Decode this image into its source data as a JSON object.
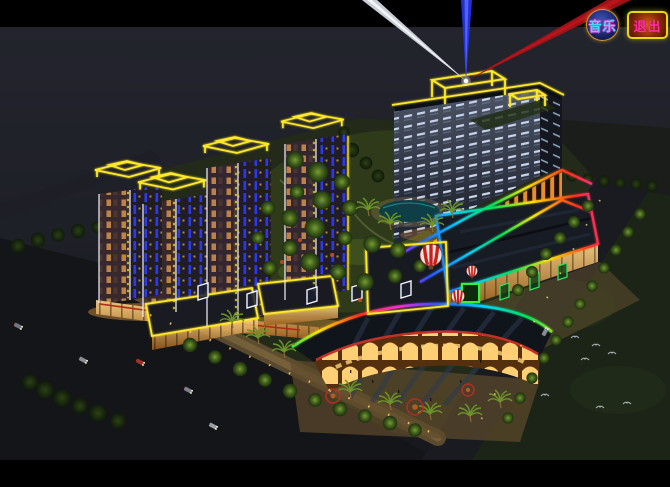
{
  "window": {
    "width": 670,
    "height": 487,
    "letterbox_color": "#000000"
  },
  "toolbar": {
    "music_button": {
      "label": "音乐",
      "text_color": "#4fd8f0",
      "border_color": "#d49a28",
      "bg_color": "#16215e"
    },
    "exit_button": {
      "label": "退出",
      "text_color": "#ff2f9e",
      "border_color": "#ecd616",
      "bg_color": "#8a2a06"
    }
  },
  "scene": {
    "subject": "aerial night lighting rendering of a mixed-use complex",
    "searchlights": [
      {
        "name": "white-beam",
        "color": "#dfe3ec"
      },
      {
        "name": "blue-beam",
        "color": "#2233dd"
      },
      {
        "name": "red-beam",
        "color": "#a91218"
      }
    ],
    "neon": {
      "yellow": "#ffe92a",
      "white": "#f2f4ff",
      "green": "#35f03c",
      "blue": "#2b3cf0",
      "rainbow": [
        "#ff2bd6",
        "#2b50ff",
        "#00d0ff",
        "#00e05a",
        "#ffe400",
        "#ff3020"
      ]
    },
    "elements": [
      "hotel-tower",
      "rooftop-neon-frames",
      "residential-towers",
      "podium-colonnade",
      "retail-strips",
      "fan-shaped-mall",
      "roof-billboards",
      "green-neon-sign",
      "striped-balloons",
      "landscaped-courtyard",
      "pond",
      "palm-trees",
      "roads",
      "street-trees",
      "cars",
      "birds"
    ]
  }
}
